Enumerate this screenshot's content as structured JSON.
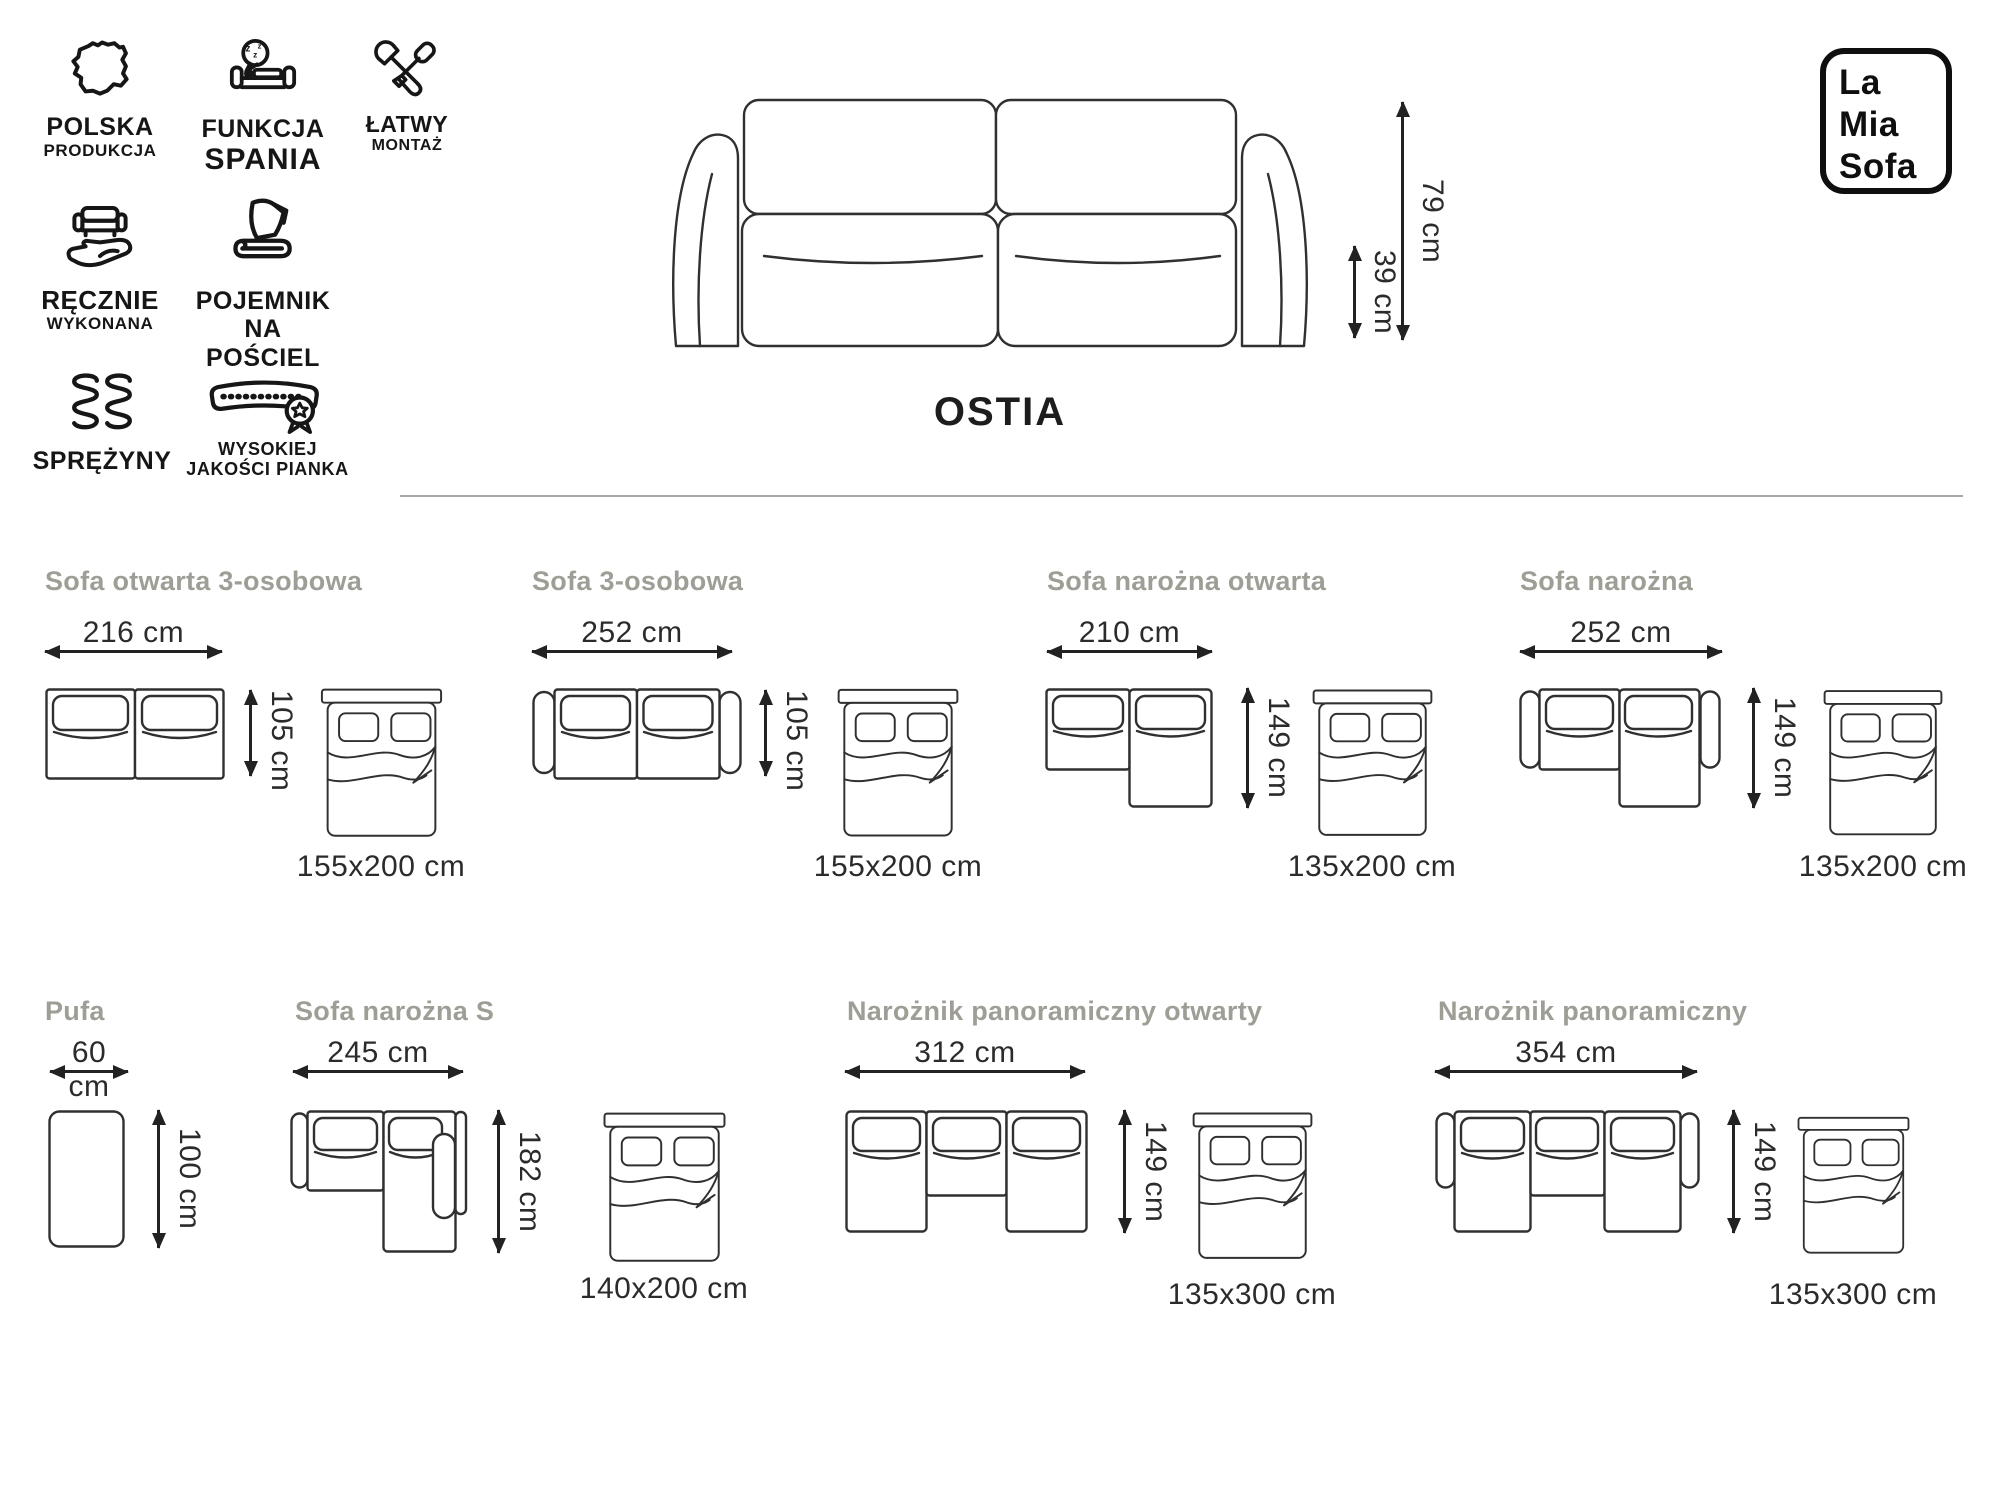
{
  "brand": {
    "line1": "La",
    "line2": "Mia",
    "line3": "Sofa"
  },
  "product": {
    "name": "OSTIA",
    "height": "79 cm",
    "seat_height": "39 cm"
  },
  "features": [
    {
      "icon": "poland-map-icon",
      "line1": "POLSKA",
      "line2": "PRODUKCJA"
    },
    {
      "icon": "sleep-function-icon",
      "line1": "FUNKCJA",
      "line2": "SPANIA"
    },
    {
      "icon": "easy-assembly-icon",
      "line1": "ŁATWY",
      "line2": "MONTAŻ"
    },
    {
      "icon": "handmade-icon",
      "line1": "RĘCZNIE",
      "line2": "WYKONANA"
    },
    {
      "icon": "bedding-container-icon",
      "line1": "POJEMNIK",
      "line2": "NA POŚCIEL"
    },
    {
      "icon": "springs-icon",
      "line1": "SPRĘŻYNY",
      "line2": ""
    },
    {
      "icon": "quality-foam-icon",
      "line1": "WYSOKIEJ",
      "line2": "JAKOŚCI PIANKA"
    }
  ],
  "configs": [
    {
      "name": "Sofa otwarta 3-osobowa",
      "width": "216 cm",
      "depth": "105 cm",
      "bed": "155x200 cm"
    },
    {
      "name": "Sofa 3-osobowa",
      "width": "252 cm",
      "depth": "105 cm",
      "bed": "155x200 cm"
    },
    {
      "name": "Sofa narożna otwarta",
      "width": "210 cm",
      "depth": "149 cm",
      "bed": "135x200 cm"
    },
    {
      "name": "Sofa narożna",
      "width": "252 cm",
      "depth": "149 cm",
      "bed": "135x200 cm"
    },
    {
      "name": "Pufa",
      "width": "60 cm",
      "depth": "100 cm",
      "bed": ""
    },
    {
      "name": "Sofa narożna S",
      "width": "245 cm",
      "depth": "182 cm",
      "bed": "140x200 cm"
    },
    {
      "name": "Narożnik panoramiczny otwarty",
      "width": "312 cm",
      "depth": "149 cm",
      "bed": "135x300 cm"
    },
    {
      "name": "Narożnik panoramiczny",
      "width": "354 cm",
      "depth": "149 cm",
      "bed": "135x300 cm"
    }
  ],
  "colors": {
    "ink": "#1d1d1d",
    "muted_title": "#9e9e96",
    "line_art": "#303030"
  }
}
